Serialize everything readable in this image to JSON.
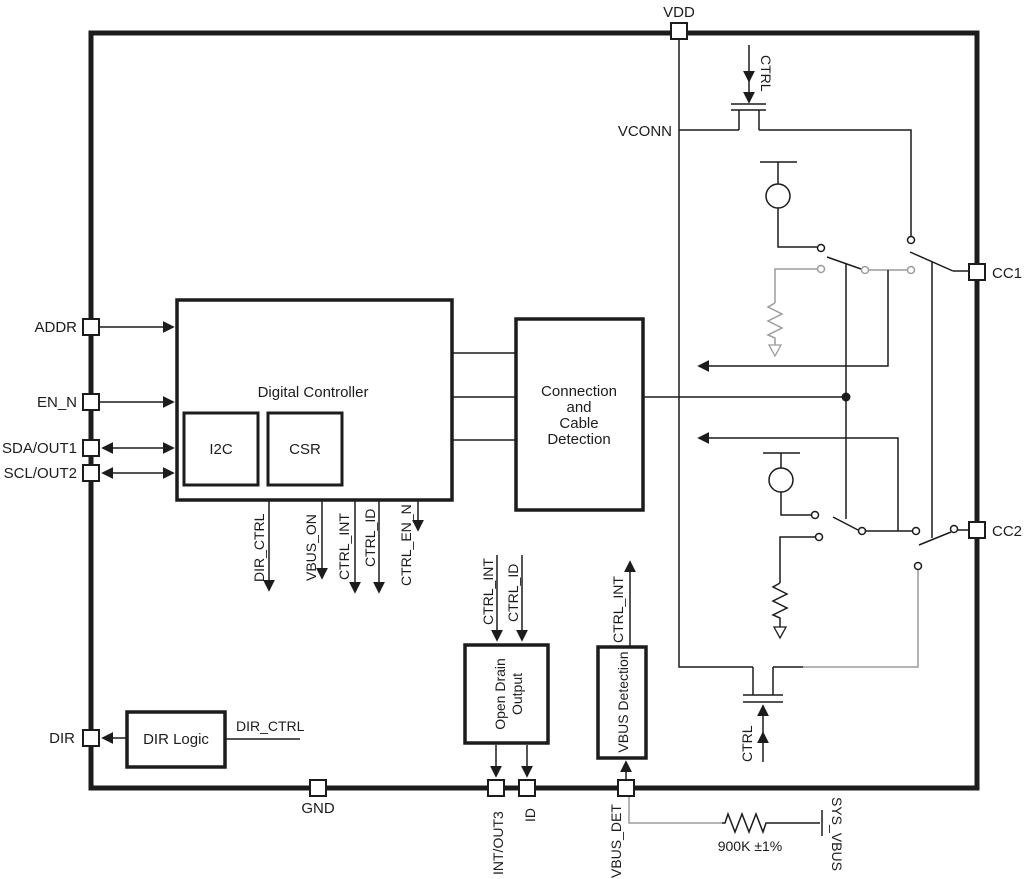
{
  "pins": {
    "vdd": "VDD",
    "cc1": "CC1",
    "cc2": "CC2",
    "addr": "ADDR",
    "en_n": "EN_N",
    "sda_out1": "SDA/OUT1",
    "scl_out2": "SCL/OUT2",
    "dir": "DIR",
    "gnd": "GND",
    "int_out3": "INT/OUT3",
    "id": "ID",
    "vbus_det": "VBUS_DET"
  },
  "blocks": {
    "digital_controller": "Digital Controller",
    "i2c": "I2C",
    "csr": "CSR",
    "connection_line1": "Connection",
    "connection_line2": "and",
    "connection_line3": "Cable",
    "connection_line4": "Detection",
    "open_drain_line1": "Open Drain",
    "open_drain_line2": "Output",
    "vbus_detection": "VBUS Detection",
    "dir_logic": "DIR Logic"
  },
  "signals": {
    "dir_ctrl": "DIR_CTRL",
    "vbus_on": "VBUS_ON",
    "ctrl_int": "CTRL_INT",
    "ctrl_id": "CTRL_ID",
    "ctrl_en_n": "CTRL_EN_N",
    "vconn": "VCONN",
    "ctrl": "CTRL"
  },
  "external": {
    "resistor_value": "900K ±1%",
    "sys_vbus": "SYS_VBUS"
  },
  "colors": {
    "line": "#1c1c1c",
    "gray": "#9c9c9c"
  }
}
